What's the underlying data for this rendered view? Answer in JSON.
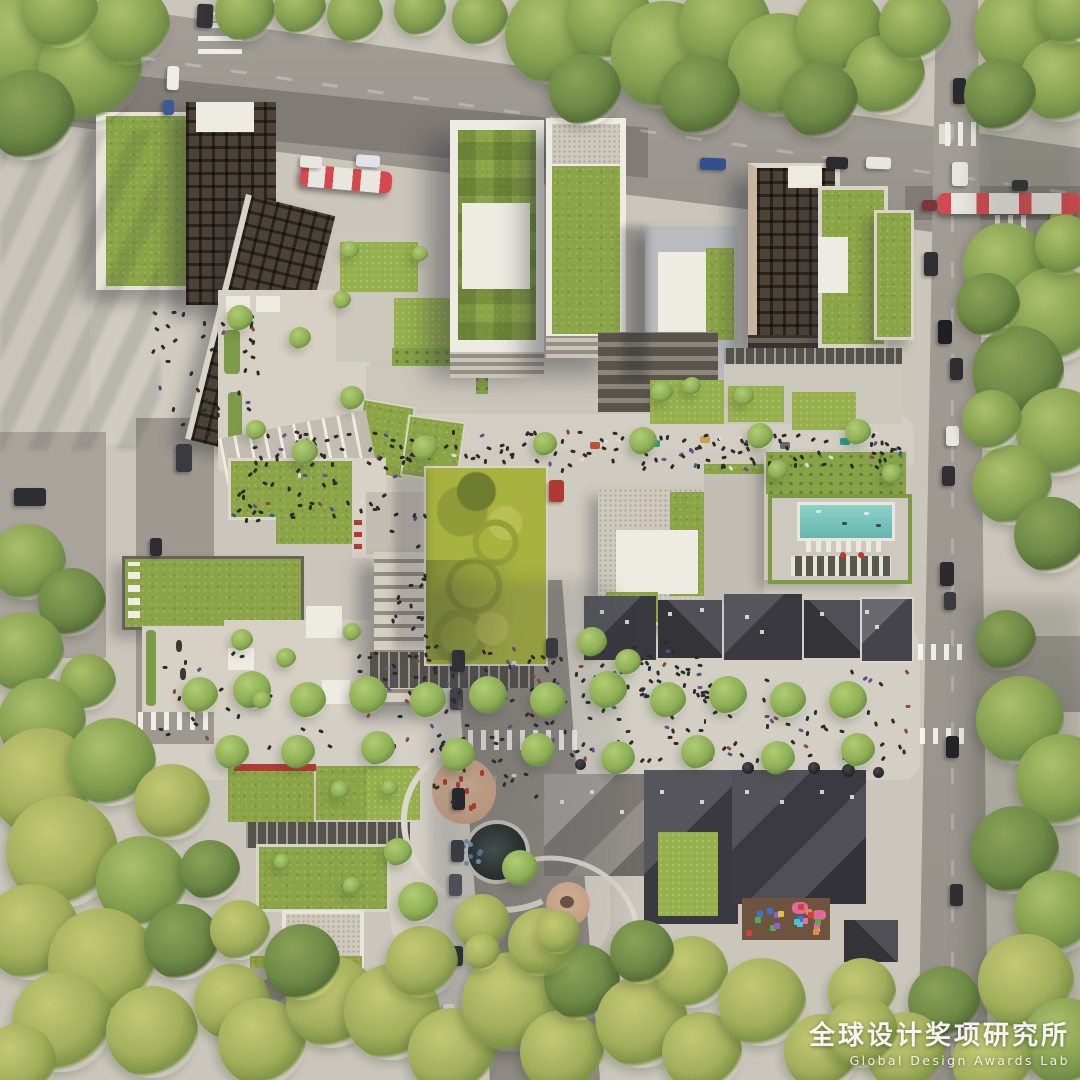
{
  "watermark": {
    "title_zh": "全球设计奖项研究所",
    "subtitle_en": "Global Design Awards Lab"
  },
  "scene": {
    "type": "aerial architectural rendering, top-down view",
    "description": "Top-down aerial rendering of a mixed-use urban block: green-roofed mid-rise towers along the north street with two red trams, a central swirl-patterned lawn plaza, rooftop terraces, a rooftop swimming pool deck with loungers, rows of charcoal pitched-roof heritage houses, a children's playground with colorful equipment, tree-lined pedestrian promenades with crowds, and perimeter streets with cars",
    "elements": [
      "green roofs",
      "red trams",
      "rooftop pool",
      "central patterned lawn",
      "rooftop terraces",
      "heritage pitched-roof houses",
      "playground",
      "tree-lined promenade",
      "street crowds",
      "crosswalks",
      "parked cars"
    ],
    "palette": {
      "pavement": "#cbc6bb",
      "asphalt": "#9b968e",
      "tramLane": "#807b75",
      "greenRoof": "#8aa446",
      "lawn": "#a7b23f",
      "treeGreen": "#87a254",
      "treeYellow": "#b4bd68",
      "cream": "#d8d2c6",
      "whiteRoof": "#edebe2",
      "darkBrown": "#4c4238",
      "charcoal": "#46454a",
      "pool": "#82cbc4",
      "tramRed": "#d5494e",
      "sand": "#d6b191",
      "redAccent": "#b23b34"
    }
  }
}
